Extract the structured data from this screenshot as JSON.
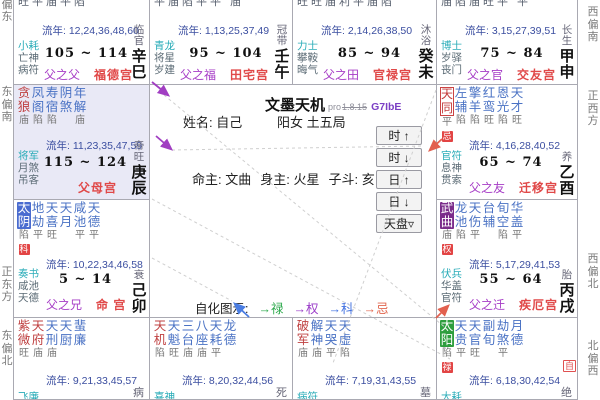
{
  "app": {
    "title": "文墨天机",
    "pro": "pro",
    "version": "1.8.15",
    "code": "G7IbE"
  },
  "center": {
    "name": "姓名: 自己",
    "gender_bureau": "阳女 土五局",
    "mingzhu": "命主: 文曲",
    "shenzhu": "身主: 火星",
    "zidou": "子斗: 亥",
    "buttons": [
      "时 ↑",
      "时 ↓",
      "日 ↑",
      "日 ↓",
      "天盘▿"
    ],
    "legend_label": "自化图示:",
    "legend_items": [
      {
        "label": "→禄",
        "color": "#2ca94c"
      },
      {
        "label": "→权",
        "color": "#9a3bc8"
      },
      {
        "label": "→科",
        "color": "#3f6fe0"
      },
      {
        "label": "→忌",
        "color": "#e2674f"
      }
    ]
  },
  "compass": {
    "left": [
      "南偏东",
      "东偏南",
      "正东方",
      "东偏北"
    ],
    "right": [
      "西偏南",
      "正西方",
      "西偏北",
      "北偏西"
    ]
  },
  "colors": {
    "main_star": "#bf4040",
    "minor_star": "#4a72c4",
    "palace": "#e04848",
    "relation": "#a63cc6",
    "liunian": "#3b4ea0",
    "hua_lu": "#2e9e3e",
    "hua_quan": "#7b2d8b",
    "hua_ke": "#4a6cd0",
    "hua_ji": "#cc4444",
    "daxian_bg": "#e9e9f6"
  },
  "cells": {
    "si": {
      "top_bright": "旺平庙平陷",
      "liunian": "流年: 12,24,36,48,60",
      "gods": [
        "小耗",
        "亡神",
        "病符"
      ],
      "age": "105 ~ 114",
      "rel": "父之父",
      "palace": "福德宫",
      "chang": "临官",
      "gz": "辛巳"
    },
    "wu": {
      "top_bright": "平庙陷平平 庙",
      "liunian": "流年: 1,13,25,37,49",
      "gods": [
        "青龙",
        "将星",
        "岁建"
      ],
      "age": "95 ~ 104",
      "rel": "父之福",
      "palace": "田宅宫",
      "chang": "冠带",
      "gz": "壬午"
    },
    "wei": {
      "top_bright": "旺旺庙利平庙陷",
      "liunian": "流年: 2,14,26,38,50",
      "gods": [
        "力士",
        "攀鞍",
        "晦气"
      ],
      "age": "85 ~ 94",
      "rel": "父之田",
      "palace": "官禄宫",
      "chang": "沐浴",
      "gz": "癸未"
    },
    "shen": {
      "top_bright": "庙陷庙旺平 平",
      "liunian": "流年: 3,15,27,39,51",
      "gods": [
        "博士",
        "岁驿",
        "丧门"
      ],
      "age": "75 ~ 84",
      "rel": "父之官",
      "palace": "交友宫",
      "chang": "长生",
      "gz": "甲申"
    },
    "chen": {
      "stars": [
        {
          "n": "贪狼",
          "c": "main",
          "b": "庙"
        },
        {
          "n": "凤阁",
          "c": "minor",
          "b": "陷"
        },
        {
          "n": "寿宿",
          "c": "minor",
          "b": "陷"
        },
        {
          "n": "阴煞",
          "c": "minor",
          "b": ""
        },
        {
          "n": "年解",
          "c": "minor",
          "b": "庙"
        }
      ],
      "liunian": "流年: 11,23,35,47,59",
      "gods": [
        "将军",
        "月煞",
        "吊客"
      ],
      "age": "115 ~ 124",
      "palace": "父母宫",
      "chang": "帝旺",
      "gz": "庚辰"
    },
    "you": {
      "stars": [
        {
          "n": "天同",
          "c": "outline-red",
          "b": "平",
          "g": "忌"
        },
        {
          "n": "左辅",
          "c": "minor",
          "b": "陷"
        },
        {
          "n": "擎羊",
          "c": "minor",
          "b": "陷"
        },
        {
          "n": "红鸾",
          "c": "minor",
          "b": "旺"
        },
        {
          "n": "恩光",
          "c": "minor",
          "b": "陷"
        },
        {
          "n": "天才",
          "c": "minor",
          "b": "旺"
        }
      ],
      "liunian": "流年: 4,16,28,40,52",
      "gods": [
        "官符",
        "息神",
        "贯索"
      ],
      "age": "65 ~ 74",
      "rel": "父之友",
      "palace": "迁移宫",
      "chang": "养",
      "gz": "乙酉"
    },
    "mao": {
      "stars": [
        {
          "n": "太阴",
          "c": "hl-blue",
          "b": "陷",
          "g": "科"
        },
        {
          "n": "地劫",
          "c": "minor",
          "b": "平"
        },
        {
          "n": "天喜",
          "c": "minor",
          "b": "旺"
        },
        {
          "n": "天月",
          "c": "minor",
          "b": ""
        },
        {
          "n": "咸池",
          "c": "minor",
          "b": "平"
        },
        {
          "n": "天德",
          "c": "minor",
          "b": "平"
        }
      ],
      "liunian": "流年: 10,22,34,46,58",
      "gods": [
        "奏书",
        "咸池",
        "天德"
      ],
      "age": "5 ~ 14",
      "rel": "父之兄",
      "palace": "命 宫",
      "chang": "衰",
      "gz": "己卯"
    },
    "xu": {
      "stars": [
        {
          "n": "武曲",
          "c": "hl-purple",
          "b": "庙",
          "g": "权"
        },
        {
          "n": "龙池",
          "c": "minor",
          "b": "陷"
        },
        {
          "n": "天伤",
          "c": "minor",
          "b": "平"
        },
        {
          "n": "台辅",
          "c": "minor",
          "b": ""
        },
        {
          "n": "旬空",
          "c": "minor",
          "b": "陷"
        },
        {
          "n": "华盖",
          "c": "minor",
          "b": "平"
        }
      ],
      "liunian": "流年: 5,17,29,41,53",
      "gods": [
        "伏兵",
        "华盖",
        "官符"
      ],
      "age": "55 ~ 64",
      "rel": "父之迁",
      "palace": "疾厄宫",
      "chang": "胎",
      "gz": "丙戌"
    },
    "yin": {
      "stars": [
        {
          "n": "紫微",
          "c": "main",
          "b": "旺"
        },
        {
          "n": "天府",
          "c": "main",
          "b": "庙"
        },
        {
          "n": "天刑",
          "c": "minor",
          "b": "庙"
        },
        {
          "n": "天厨",
          "c": "minor",
          "b": ""
        },
        {
          "n": "蜚廉",
          "c": "minor",
          "b": ""
        }
      ],
      "liunian": "流年: 9,21,33,45,57",
      "gods": [
        "飞廉"
      ],
      "chang": "病"
    },
    "chou": {
      "stars": [
        {
          "n": "天机",
          "c": "main",
          "b": "陷"
        },
        {
          "n": "天魁",
          "c": "minor",
          "b": "旺"
        },
        {
          "n": "三台",
          "c": "minor",
          "b": "庙"
        },
        {
          "n": "八座",
          "c": "minor",
          "b": "庙"
        },
        {
          "n": "天耗",
          "c": "minor",
          "b": "平"
        },
        {
          "n": "龙德",
          "c": "minor",
          "b": ""
        }
      ],
      "liunian": "流年: 8,20,32,44,56",
      "gods": [
        "喜神"
      ],
      "chang": "死"
    },
    "zi": {
      "stars": [
        {
          "n": "破军",
          "c": "main",
          "b": "庙"
        },
        {
          "n": "解神",
          "c": "minor",
          "b": "庙"
        },
        {
          "n": "天哭",
          "c": "minor",
          "b": "平"
        },
        {
          "n": "天虚",
          "c": "minor",
          "b": "陷"
        }
      ],
      "liunian": "流年: 7,19,31,43,55",
      "gods": [
        "病符"
      ],
      "chang": "墓"
    },
    "hai": {
      "stars": [
        {
          "n": "太阳",
          "c": "hl-green",
          "b": "陷",
          "g": "禄"
        },
        {
          "n": "天贵",
          "c": "minor",
          "b": "平"
        },
        {
          "n": "天官",
          "c": "minor",
          "b": "旺"
        },
        {
          "n": "副旬",
          "c": "minor",
          "b": ""
        },
        {
          "n": "劫煞",
          "c": "minor",
          "b": "平"
        },
        {
          "n": "月德",
          "c": "minor",
          "b": ""
        }
      ],
      "liunian": "流年: 6,18,30,42,54",
      "gods": [
        "大耗"
      ],
      "chang": "绝",
      "selfhua": "自"
    }
  }
}
